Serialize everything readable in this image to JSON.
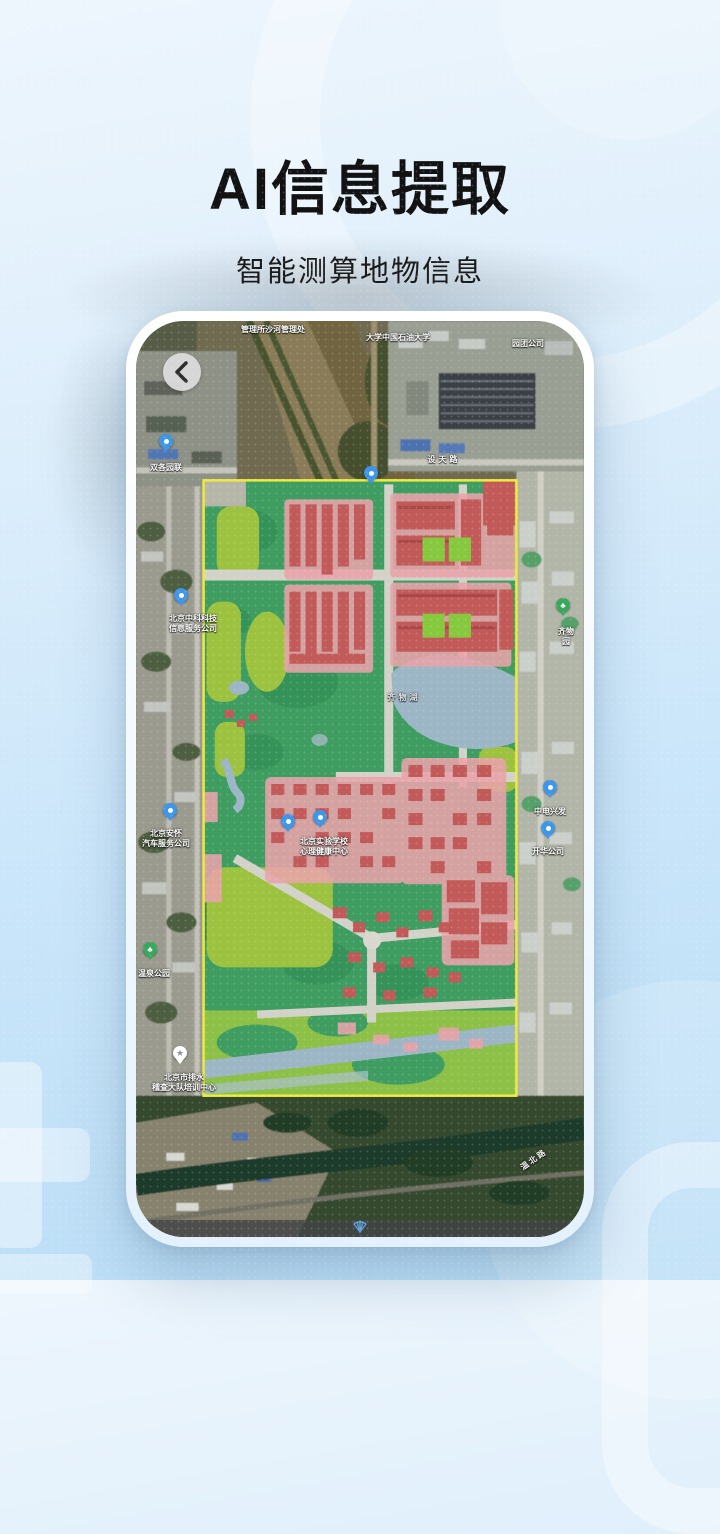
{
  "hero": {
    "title": "AI信息提取",
    "subtitle": "智能测算地物信息"
  },
  "phone": {
    "back_button": "back-chevron",
    "bottom_bar_icon": "shell-compass"
  },
  "map": {
    "labels": [
      {
        "text": "管理所沙河管理处",
        "x": 137,
        "y": 4
      },
      {
        "text": "大学中国石油大学",
        "x": 262,
        "y": 12
      },
      {
        "text": "园团公司",
        "x": 392,
        "y": 18
      },
      {
        "text": "双各园联",
        "x": 30,
        "y": 142,
        "pin": "blue",
        "pin_x": 30,
        "pin_y": 120
      },
      {
        "text": "设天路",
        "x": 308,
        "y": 134,
        "cls": "road"
      },
      {
        "text": "北京中科科技\n信息服务公司",
        "x": 57,
        "y": 293,
        "pin": "blue",
        "pin_x": 45,
        "pin_y": 274
      },
      {
        "text": "齐物园",
        "x": 430,
        "y": 306,
        "pin": "green",
        "pin_x": 427,
        "pin_y": 284
      },
      {
        "text": "齐物湖",
        "x": 268,
        "y": 372,
        "cls": "water-label"
      },
      {
        "text": "北京实验学校\n心理健康中心",
        "x": 188,
        "y": 516,
        "pin": "blue",
        "pin_x": 184,
        "pin_y": 496
      },
      {
        "text": "中电兴发",
        "x": 414,
        "y": 486,
        "pin": "blue",
        "pin_x": 414,
        "pin_y": 466
      },
      {
        "text": "开华公司",
        "x": 412,
        "y": 526,
        "pin": "blue",
        "pin_x": 412,
        "pin_y": 507
      },
      {
        "text": "北京安怀\n汽车服务公司",
        "x": 30,
        "y": 508,
        "pin": "blue",
        "pin_x": 34,
        "pin_y": 489
      },
      {
        "text": "北京市排水\n稽查大队培训中心",
        "x": 48,
        "y": 752,
        "pin": "star",
        "pin_x": 44,
        "pin_y": 732
      },
      {
        "text": "温北路",
        "x": 398,
        "y": 834,
        "cls": "road-dark",
        "rotate": -35
      },
      {
        "text": "温泉公园",
        "x": 18,
        "y": 648,
        "pin": "green",
        "pin_x": 14,
        "pin_y": 628
      }
    ],
    "pins": [
      {
        "type": "blue",
        "x": 235,
        "y": 152
      },
      {
        "type": "blue",
        "x": 152,
        "y": 500
      }
    ],
    "palette": {
      "vegetation_overlay": "#3f9d62",
      "vegetation_light": "#9cc23f",
      "building_overlay": "#c25a5a",
      "building_light": "#e9a3aa",
      "water_overlay": "#9cb6c6",
      "road": "#d2d2c8",
      "region_boundary": "#eeea3d"
    }
  },
  "colors": {
    "background_top": "#eef6fd",
    "background_bottom": "#b9ddf6",
    "title_text": "#121212"
  }
}
